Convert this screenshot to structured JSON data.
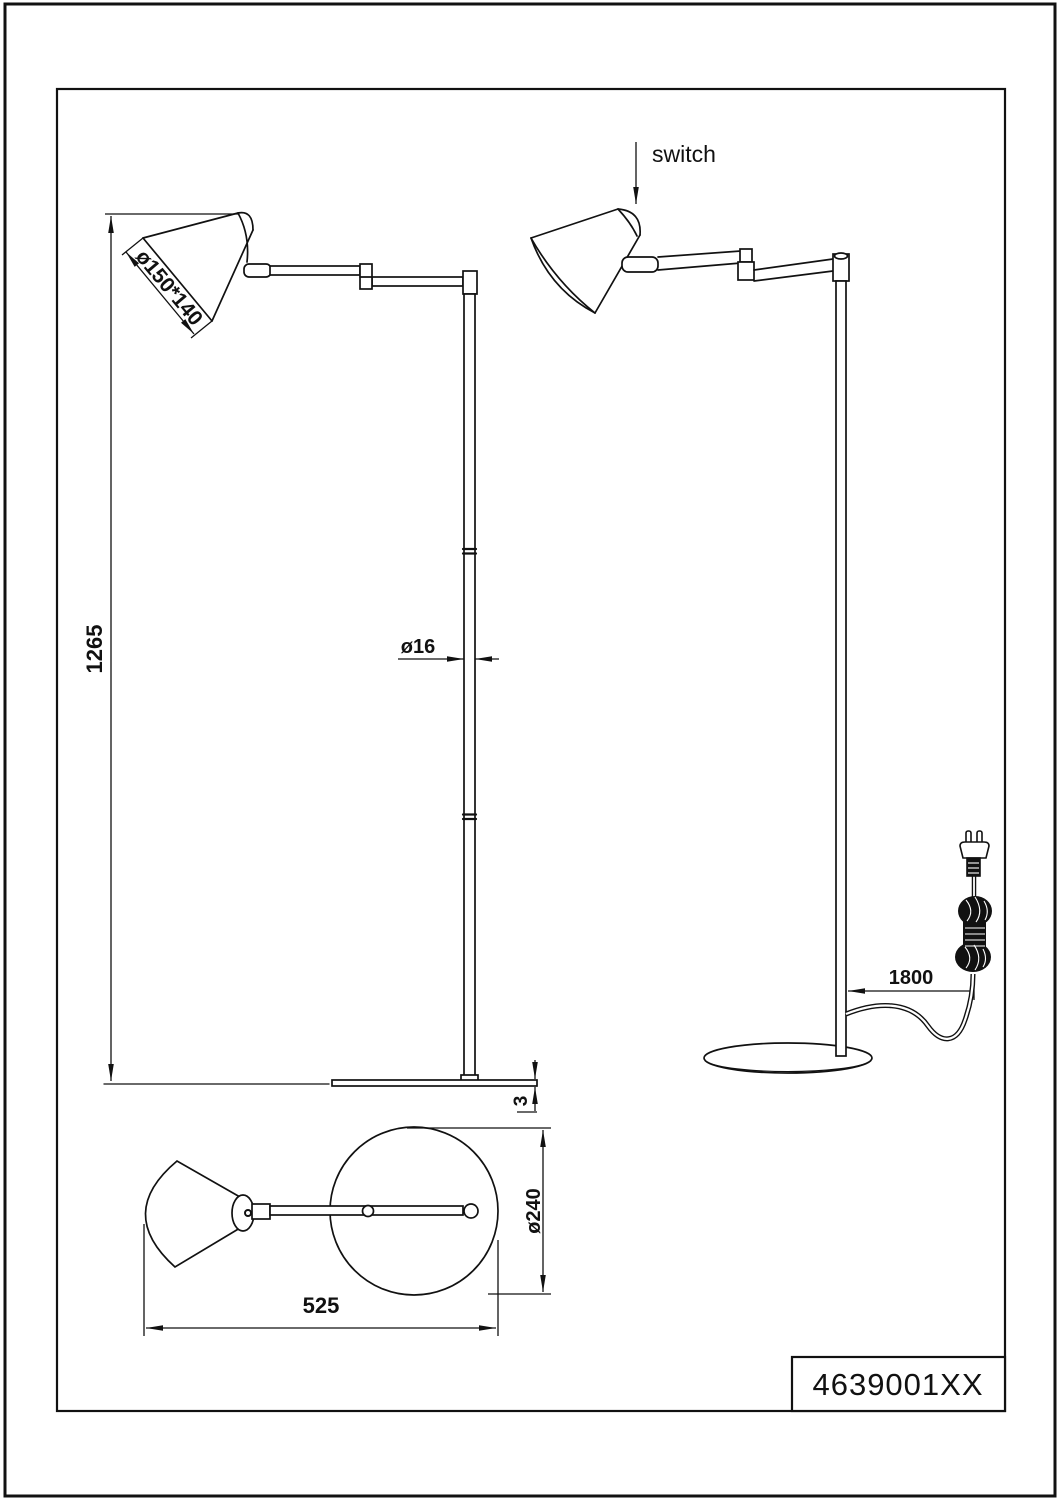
{
  "colors": {
    "line": "#111111",
    "background": "#ffffff"
  },
  "labels": {
    "switch": "switch"
  },
  "views": {
    "front": {
      "height_dim": "1265",
      "pole_diameter_dim": "ø16",
      "shade_dim": "ø150*140",
      "base_thickness_dim": "3"
    },
    "side": {
      "cord_length_dim": "1800"
    },
    "top": {
      "overall_width_dim": "525",
      "base_diameter_dim": "ø240"
    }
  },
  "title_block": {
    "part_number": "4639001XX"
  }
}
